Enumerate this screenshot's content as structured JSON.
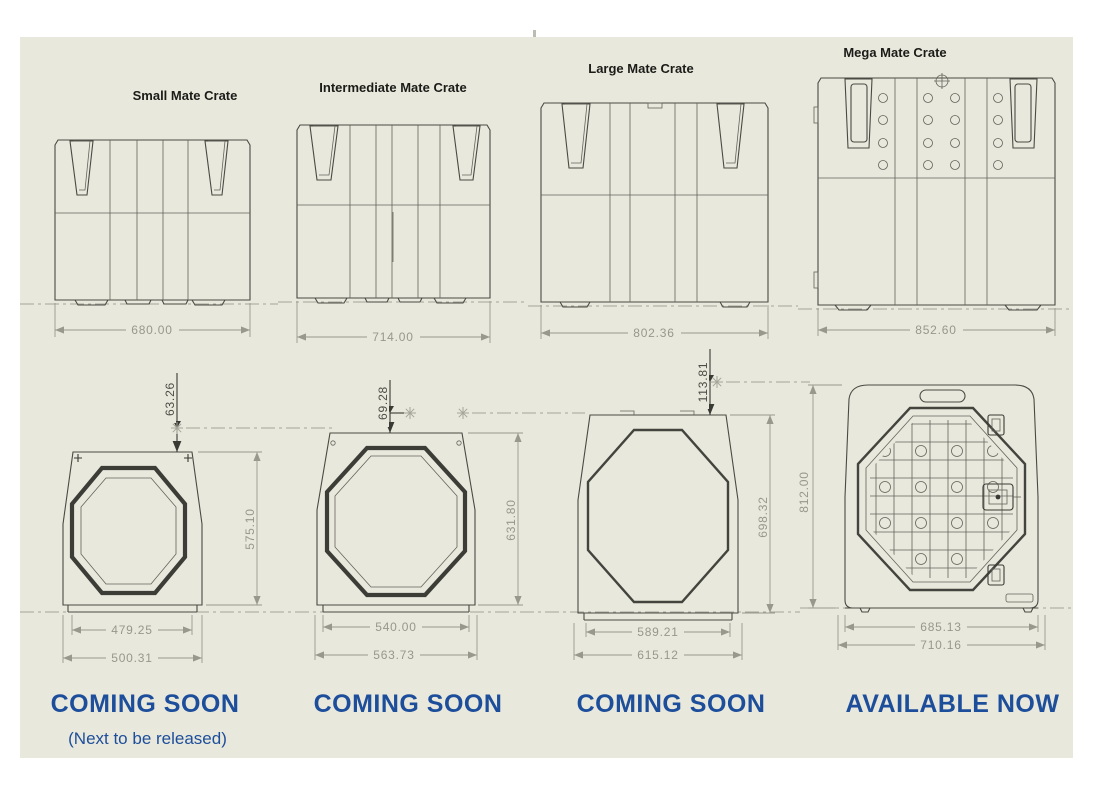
{
  "colors": {
    "page_background": "#ffffff",
    "canvas_background": "#e9e8dc",
    "accent_blue": "#1d4e9b",
    "drawing_line": "#4a4a45",
    "dimension_grey": "#97978c"
  },
  "crates": [
    {
      "title": "Small Mate Crate",
      "side_width": "680.00",
      "front": {
        "top_offset": "63.26",
        "height": "575.10",
        "door_width": "479.25",
        "overall_width": "500.31"
      },
      "status": "COMING SOON",
      "note": "(Next to be released)"
    },
    {
      "title": "Intermediate Mate Crate",
      "side_width": "714.00",
      "front": {
        "top_offset": "69.28",
        "height": "631.80",
        "door_width": "540.00",
        "overall_width": "563.73"
      },
      "status": "COMING SOON"
    },
    {
      "title": "Large Mate Crate",
      "side_width": "802.36",
      "front": {
        "top_offset": "113.81",
        "height": "698.32",
        "door_width": "589.21",
        "overall_width": "615.12"
      },
      "status": "COMING SOON"
    },
    {
      "title": "Mega Mate Crate",
      "side_width": "852.60",
      "front": {
        "height": "812.00",
        "door_width": "685.13",
        "overall_width": "710.16"
      },
      "status": "AVAILABLE NOW"
    }
  ]
}
